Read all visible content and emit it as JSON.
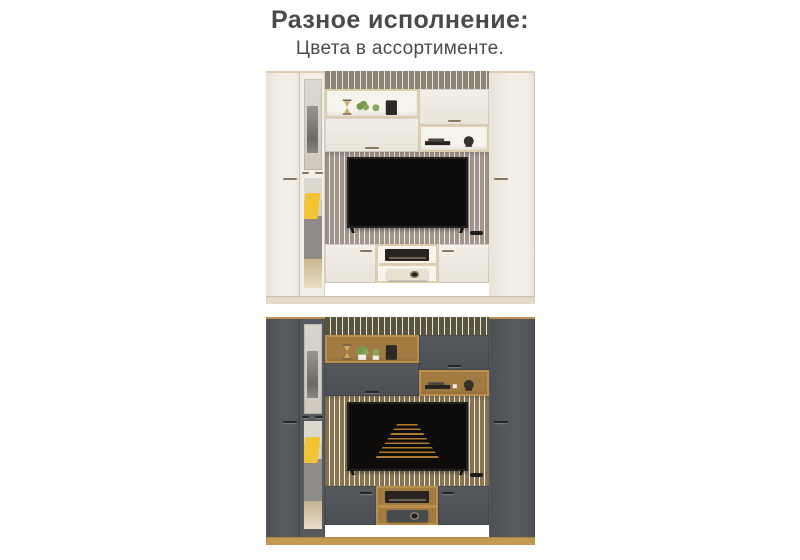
{
  "header": {
    "title": "Разное исполнение:",
    "subtitle": "Цвета в ассортименте.",
    "text_color": "#4a4a4a"
  },
  "figures": [
    {
      "id": "wall-unit-photo-white",
      "screen": "off",
      "palette": {
        "front": "#f3efe8",
        "frontShade": "#e9e4d9",
        "edge": "#dcd4c4",
        "trim": "#ddcfae",
        "wall": "#8d8475",
        "interior": "#f7f4ee",
        "panel": "#a2968a",
        "base": "#e5dbc6",
        "handle": "#84785f",
        "device": "#e9e2d2",
        "floor": "#ccb88f",
        "mirrorTop": "#dcd8d0"
      }
    },
    {
      "id": "wall-unit-photo-graphite",
      "screen": "movie-text-crawl",
      "palette": {
        "front": "#56595d",
        "frontShade": "#4c4f53",
        "edge": "#3f4246",
        "trim": "#bb8f4c",
        "wall": "#59553d",
        "interior": "#a27b42",
        "panel": "#887550",
        "base": "#c29a54",
        "handle": "#232528",
        "device": "#484b4e",
        "floor": "#c5b394",
        "mirrorTop": "#d8d4cc"
      }
    }
  ],
  "decor": {
    "pillow": "#f2c434",
    "sofa": "#8f8c87",
    "plant": "#76994f",
    "plant2": "#87a75e",
    "speaker": "#2c2927",
    "tv_screen": "#0d0c0b",
    "tv_bezel": "#232220",
    "crawl_text": "#c08631",
    "receiver": "#28231f"
  }
}
